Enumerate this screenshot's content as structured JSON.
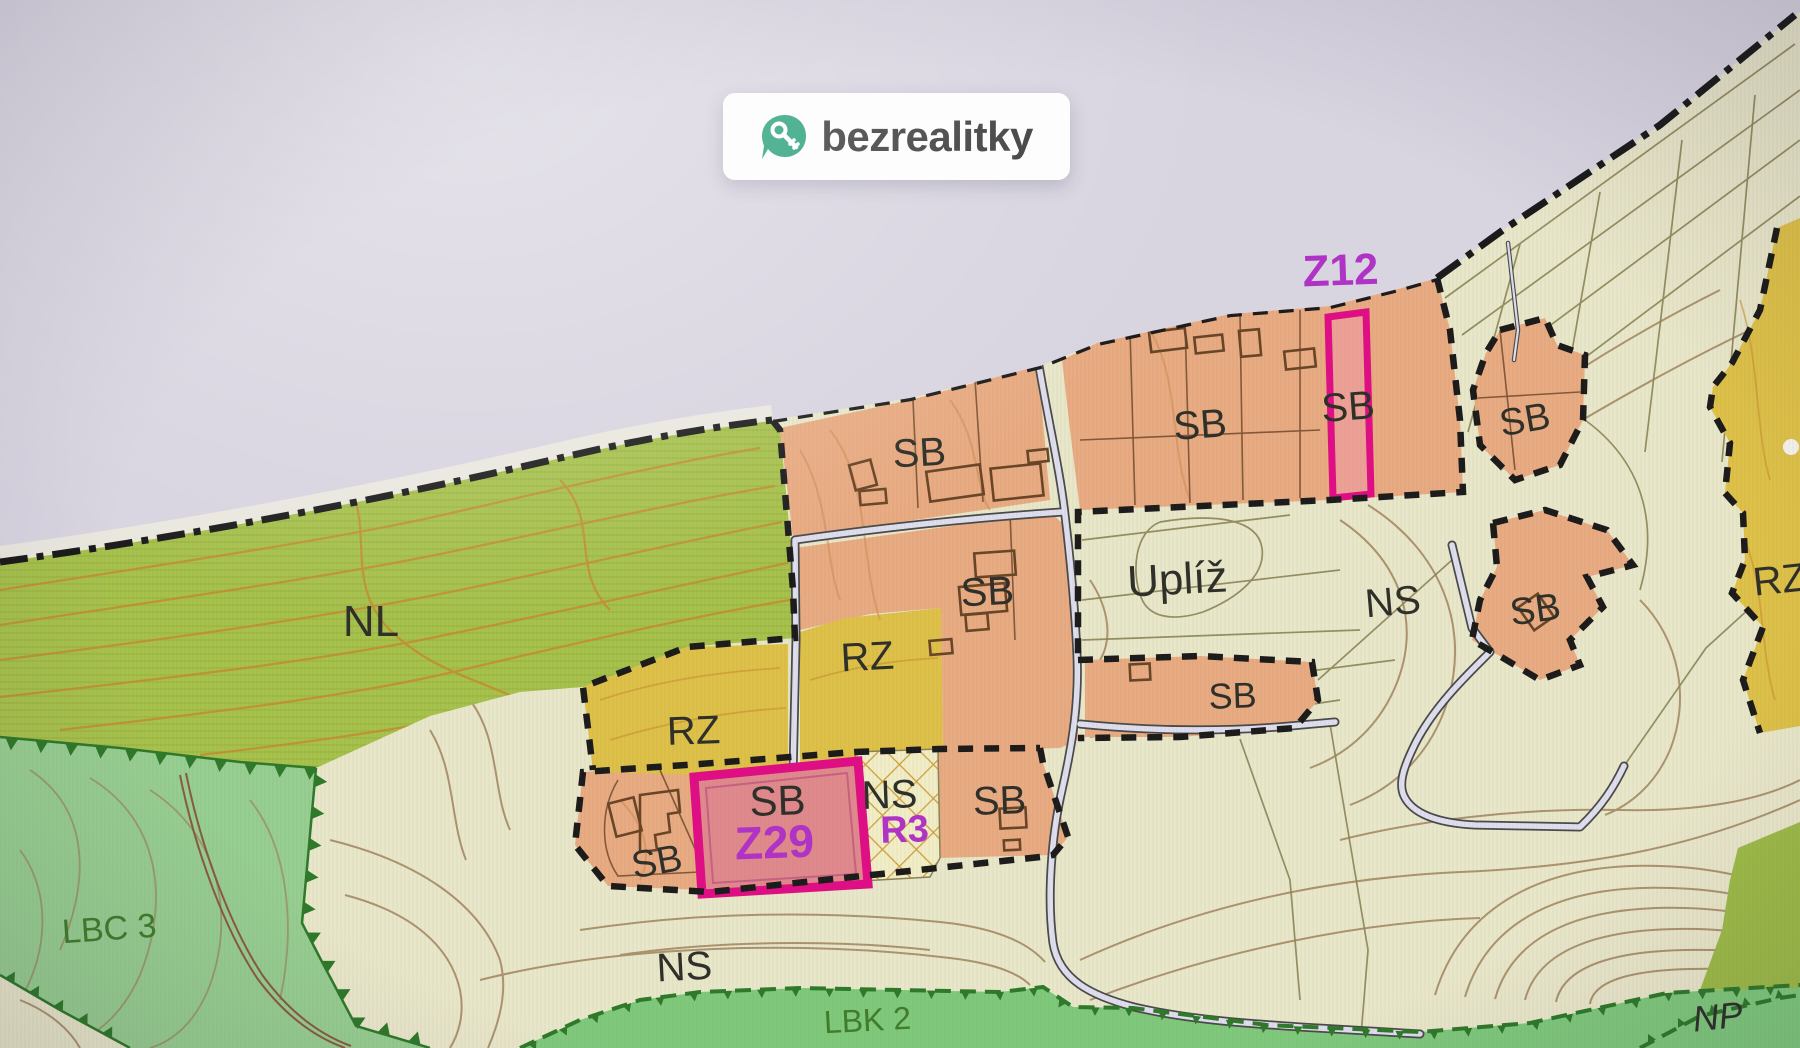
{
  "logo": {
    "text": "bezrealitky",
    "icon": "pin-key-icon"
  },
  "map": {
    "plan_labels": {
      "z12": "Z12",
      "z29": "Z29",
      "r3": "R3"
    },
    "zone_labels": {
      "sb": [
        "SB",
        "SB",
        "SB",
        "SB",
        "SB",
        "SB",
        "SB",
        "SB",
        "SB",
        "SB"
      ],
      "rz": [
        "RZ",
        "RZ",
        "RZ"
      ],
      "ns": [
        "NS",
        "NS",
        "NS"
      ],
      "nl": "NL",
      "upliz": "Uplíž",
      "lbc3": "LBC 3",
      "lbk2": "LBK 2",
      "np": "NP"
    },
    "colors": {
      "background": "#d8d4e0",
      "cream": "#e9e7c9",
      "olive": "#a7c24a",
      "olive_streak": "#93ad37",
      "light_green": "#96cf90",
      "strip_green": "#7dca7b",
      "olive_patch": "#9dbb45",
      "salmon": "#ebab80",
      "yellow": "#dfc145",
      "crosshatch_bg": "#f1edc5",
      "crosshatch_line": "#cf9d36",
      "z12_fill": "#efa195",
      "z29_fill": "#e2888d",
      "highlight_magenta": "#e50c86",
      "magenta_text": "#b232c8",
      "road_fill": "#dfdeee",
      "road_casing": "#4a4a4a",
      "boundary_black": "#1b1b1b",
      "contour_orange": "#c68c2e",
      "contour_brown": "#9d7f58",
      "parcel_line": "#8b8456",
      "building_line": "#6a4526",
      "biocorridor_green": "#2c7a28",
      "redline": "#8a5a42",
      "label_dark": "#30302a",
      "label_green": "#3f7d2a",
      "logo_green": "#2aa17b",
      "logo_text_color": "#3b3b3b",
      "margin_pale": "#edebdd"
    }
  }
}
